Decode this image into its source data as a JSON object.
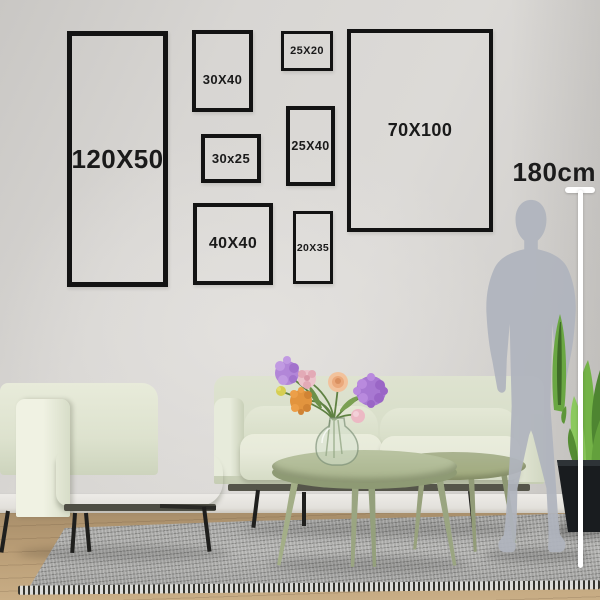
{
  "frames": [
    {
      "label": "120X50"
    },
    {
      "label": "30X40"
    },
    {
      "label": "25X20"
    },
    {
      "label": "30x25"
    },
    {
      "label": "25X40"
    },
    {
      "label": "70X100"
    },
    {
      "label": "40X40"
    },
    {
      "label": "20X35"
    }
  ],
  "measure": {
    "height_label": "180cm"
  },
  "colors": {
    "frame_border": "#131313",
    "label_text": "#1a1a1a",
    "wall": "#d6d4d1",
    "silhouette": "#afb4bd",
    "measuring_stick": "#ffffff",
    "sofa_fabric": "#e0e5d2",
    "coffee_table": "#aeb996",
    "rug": "#a6a6a4",
    "floor_wood": "#b89c75",
    "plant_leaf": "#74b347",
    "plant_pot": "#1a1d20"
  }
}
